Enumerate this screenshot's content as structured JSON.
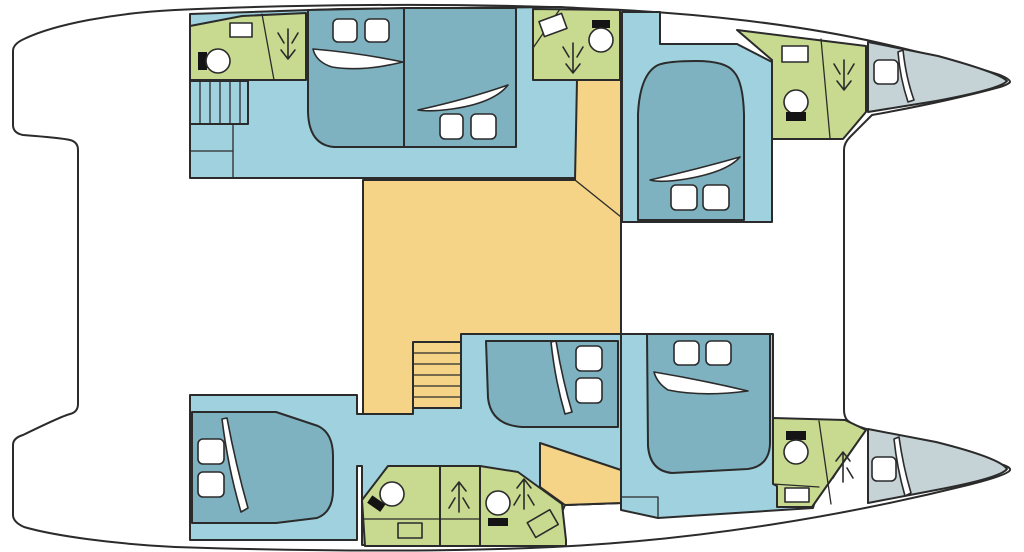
{
  "window": {
    "title": "Catamaran deck plan"
  },
  "colors": {
    "outline": "#2b2b2b",
    "white": "#ffffff",
    "black": "#141414",
    "floor": "#9fd1de",
    "bed": "#7fb2c0",
    "bathroom": "#c8da90",
    "salon": "#f5d387",
    "bow": "#c5d3d7"
  },
  "legend": {
    "floor": "cabin floor",
    "bed": "double berth",
    "bathroom": "bathroom / shower",
    "salon": "salon and companionways",
    "bow": "bow locker"
  },
  "plan": {
    "vessel_type": "catamaran",
    "view": "top-down interior layout",
    "hulls": 2,
    "berths": 6,
    "bathroom_zones": 6,
    "staircases": 2,
    "bow_lockers": 2
  },
  "icons": {
    "toilet": "toilet-icon",
    "sink": "sink-icon",
    "shower_arrow": "shower-arrow-icon",
    "pillow": "pillow",
    "duvet": "duvet-fold",
    "hatch": "hatch-icon",
    "stairs": "stairs"
  }
}
